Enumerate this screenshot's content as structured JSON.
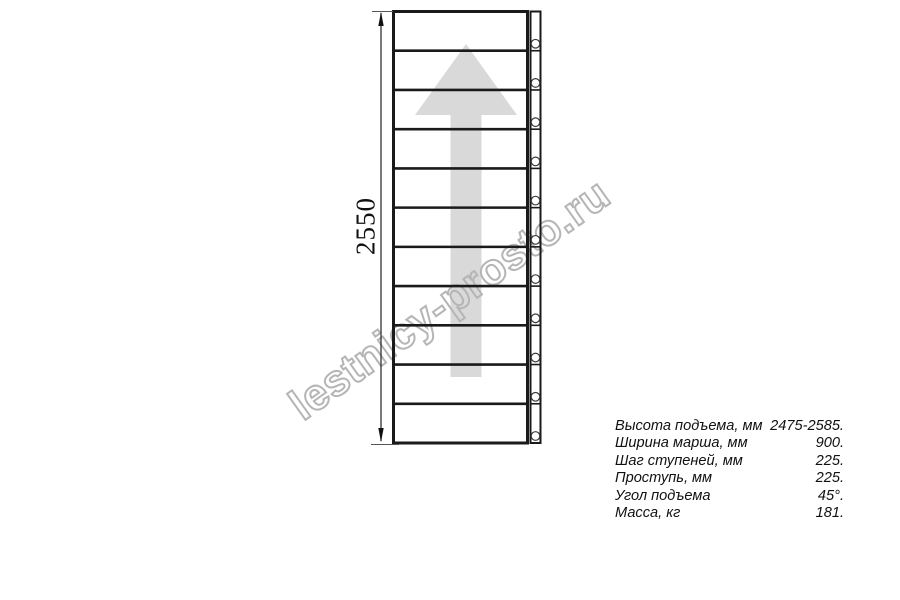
{
  "drawing": {
    "type": "staircase-plan-top-view",
    "dimension_label": "2550",
    "steps_shown": 11,
    "arrow_direction": "up",
    "colors": {
      "line": "#1a1a1a",
      "arrow_fill": "#d9d9d9",
      "watermark_outline": "#b5b5b5",
      "text": "#111111"
    }
  },
  "watermark": {
    "text": "lestnicy-prosto.ru"
  },
  "specs": {
    "rows": [
      {
        "label": "Высота подъема, мм",
        "value": "2475-2585."
      },
      {
        "label": "Ширина марша, мм",
        "value": "900."
      },
      {
        "label": "Шаг ступеней, мм",
        "value": "225."
      },
      {
        "label": "Проступь, мм",
        "value": "225."
      },
      {
        "label": "Угол подъема",
        "value": "45°."
      },
      {
        "label": "Масса, кг",
        "value": "181."
      }
    ]
  }
}
